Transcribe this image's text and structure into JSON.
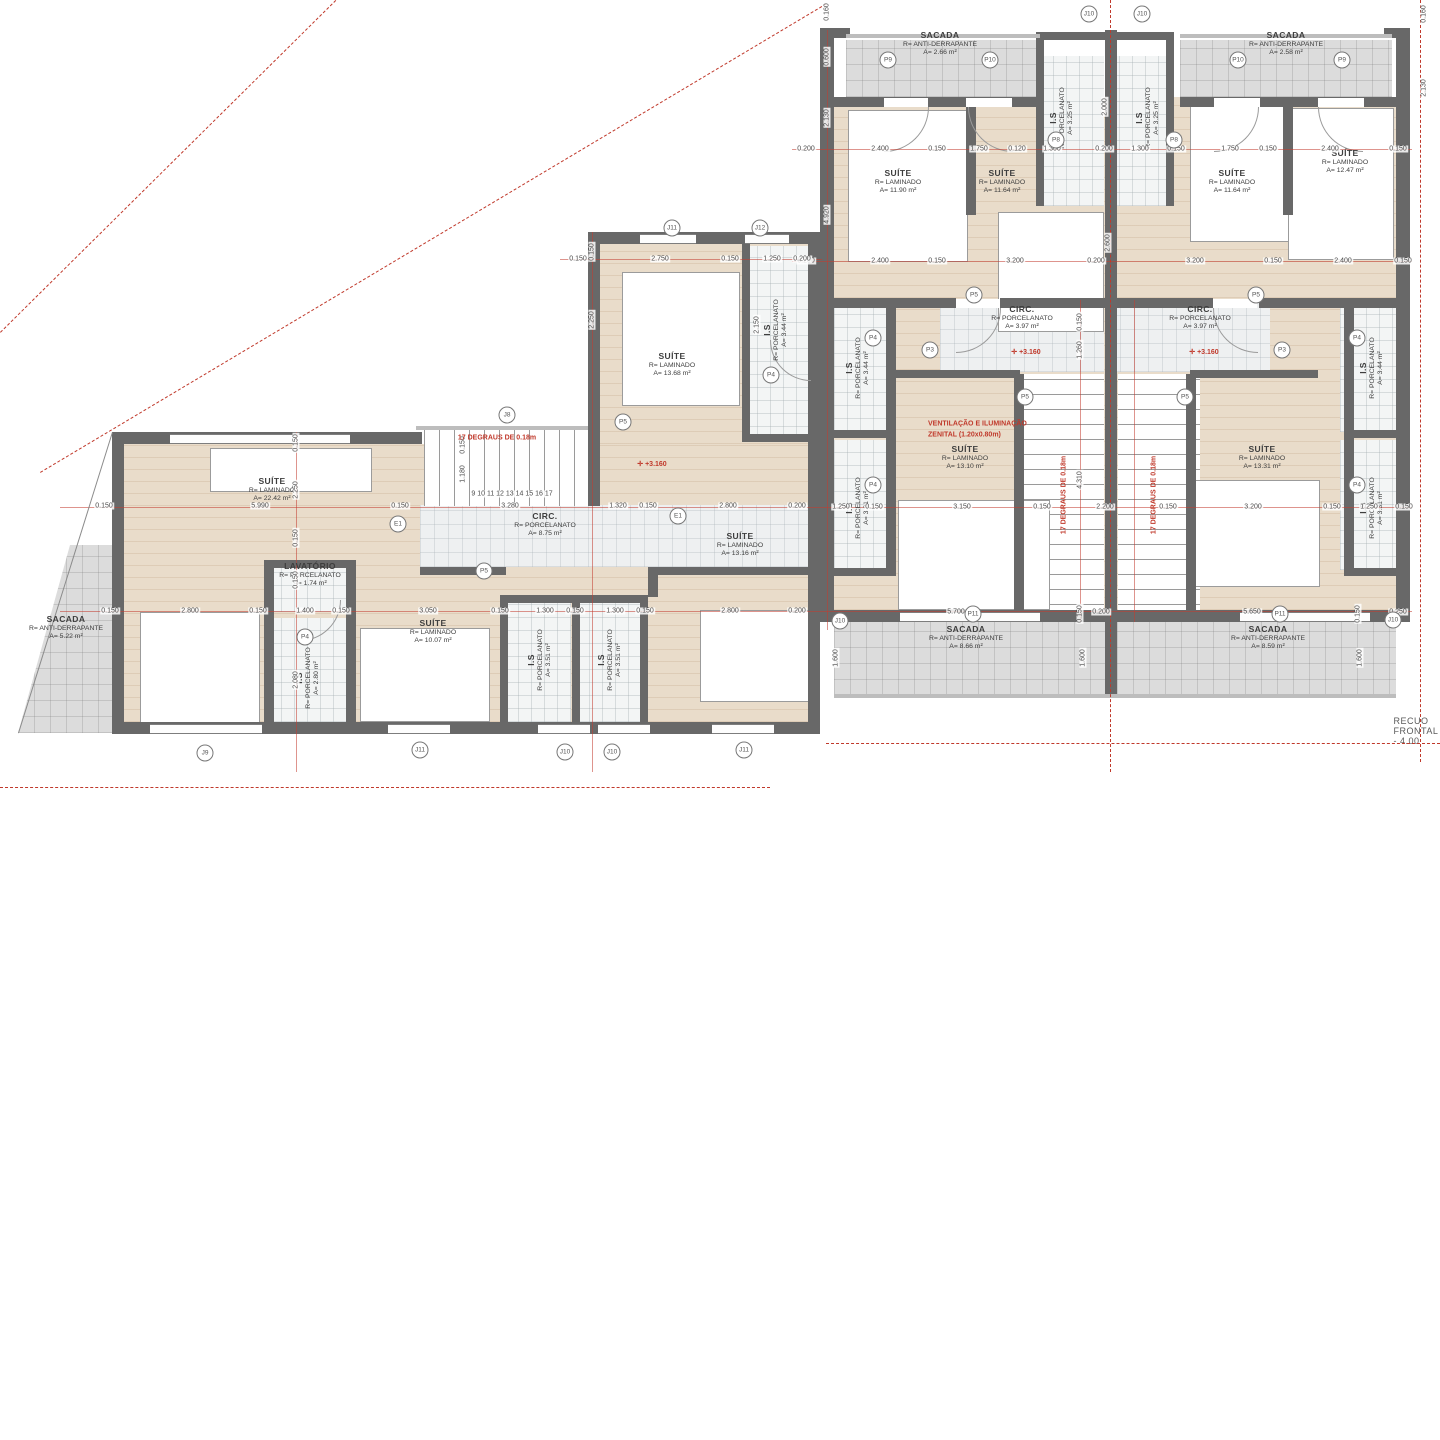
{
  "plan": {
    "recuo_label": "RECUO FRONTAL - 4.00",
    "rooms": [
      {
        "name": "sacada-esq",
        "x": 66,
        "y": 628,
        "rot": 0,
        "lines": [
          "SACADA",
          "R= ANTI-DERRAPANTE",
          "A= 5.22 m²"
        ]
      },
      {
        "name": "suite-2242",
        "x": 272,
        "y": 490,
        "rot": 0,
        "lines": [
          "SUÍTE",
          "R= LAMINADO",
          "A= 22.42 m²"
        ]
      },
      {
        "name": "circ-875",
        "x": 545,
        "y": 525,
        "rot": 0,
        "lines": [
          "CIRC.",
          "R= PORCELANATO",
          "A= 8.75 m²"
        ]
      },
      {
        "name": "suite-1368",
        "x": 672,
        "y": 365,
        "rot": 0,
        "lines": [
          "SUÍTE",
          "R= LAMINADO",
          "A= 13.68 m²"
        ]
      },
      {
        "name": "is-344-esq",
        "x": 776,
        "y": 330,
        "rot": 90,
        "lines": [
          "I.S",
          "R= PORCELANATO",
          "A= 3.44 m²"
        ]
      },
      {
        "name": "lavatorio",
        "x": 310,
        "y": 575,
        "rot": 0,
        "lines": [
          "LAVATÓRIO",
          "R= PORCELANATO",
          "A= 1.74 m²"
        ]
      },
      {
        "name": "suite-1007",
        "x": 433,
        "y": 632,
        "rot": 0,
        "lines": [
          "SUÍTE",
          "R= LAMINADO",
          "A= 10.07 m²"
        ]
      },
      {
        "name": "is-280",
        "x": 308,
        "y": 678,
        "rot": 90,
        "lines": [
          "I.S",
          "R= PORCELANATO",
          "A= 2.80 m²"
        ]
      },
      {
        "name": "is-351a",
        "x": 540,
        "y": 660,
        "rot": 90,
        "lines": [
          "I.S",
          "R= PORCELANATO",
          "A= 3.51 m²"
        ]
      },
      {
        "name": "is-351b",
        "x": 610,
        "y": 660,
        "rot": 90,
        "lines": [
          "I.S",
          "R= PORCELANATO",
          "A= 3.51 m²"
        ]
      },
      {
        "name": "suite-1316",
        "x": 740,
        "y": 545,
        "rot": 0,
        "lines": [
          "SUÍTE",
          "R= LAMINADO",
          "A= 13.16 m²"
        ]
      },
      {
        "name": "sacada-topo-a",
        "x": 940,
        "y": 44,
        "rot": 0,
        "lines": [
          "SACADA",
          "R= ANTI-DERRAPANTE",
          "A= 2.66 m²"
        ]
      },
      {
        "name": "sacada-topo-b",
        "x": 1286,
        "y": 44,
        "rot": 0,
        "lines": [
          "SACADA",
          "R= ANTI-DERRAPANTE",
          "A= 2.58 m²"
        ]
      },
      {
        "name": "is-325a",
        "x": 1062,
        "y": 118,
        "rot": 90,
        "lines": [
          "I.S",
          "R= PORCELANATO",
          "A= 3.25 m²"
        ]
      },
      {
        "name": "is-325b",
        "x": 1148,
        "y": 118,
        "rot": 90,
        "lines": [
          "I.S",
          "R= PORCELANATO",
          "A= 3.25 m²"
        ]
      },
      {
        "name": "suite-1190",
        "x": 898,
        "y": 182,
        "rot": 0,
        "lines": [
          "SUÍTE",
          "R= LAMINADO",
          "A= 11.90 m²"
        ]
      },
      {
        "name": "suite-1164a",
        "x": 1002,
        "y": 182,
        "rot": 0,
        "lines": [
          "SUÍTE",
          "R= LAMINADO",
          "A= 11.64 m²"
        ]
      },
      {
        "name": "suite-1164b",
        "x": 1232,
        "y": 182,
        "rot": 0,
        "lines": [
          "SUÍTE",
          "R= LAMINADO",
          "A= 11.64 m²"
        ]
      },
      {
        "name": "suite-1247",
        "x": 1345,
        "y": 162,
        "rot": 0,
        "lines": [
          "SUÍTE",
          "R= LAMINADO",
          "A= 12.47 m²"
        ]
      },
      {
        "name": "circ-397a",
        "x": 1022,
        "y": 318,
        "rot": 0,
        "lines": [
          "CIRC.",
          "R= PORCELANATO",
          "A= 3.97 m²"
        ]
      },
      {
        "name": "circ-397b",
        "x": 1200,
        "y": 318,
        "rot": 0,
        "lines": [
          "CIRC.",
          "R= PORCELANATO",
          "A= 3.97 m²"
        ]
      },
      {
        "name": "is-344a",
        "x": 858,
        "y": 368,
        "rot": 90,
        "lines": [
          "I.S",
          "R= PORCELANATO",
          "A= 3.44 m²"
        ]
      },
      {
        "name": "is-331a",
        "x": 858,
        "y": 508,
        "rot": 90,
        "lines": [
          "I.S",
          "R= PORCELANATO",
          "A= 3.31 m²"
        ]
      },
      {
        "name": "suite-1310",
        "x": 965,
        "y": 458,
        "rot": 0,
        "lines": [
          "SUÍTE",
          "R= LAMINADO",
          "A= 13.10 m²"
        ]
      },
      {
        "name": "suite-1331",
        "x": 1262,
        "y": 458,
        "rot": 0,
        "lines": [
          "SUÍTE",
          "R= LAMINADO",
          "A= 13.31 m²"
        ]
      },
      {
        "name": "is-344b",
        "x": 1372,
        "y": 368,
        "rot": 90,
        "lines": [
          "I.S",
          "R= PORCELANATO",
          "A= 3.44 m²"
        ]
      },
      {
        "name": "is-331b",
        "x": 1372,
        "y": 508,
        "rot": 90,
        "lines": [
          "I.S",
          "R= PORCELANATO",
          "A= 3.31 m²"
        ]
      },
      {
        "name": "sacada-baixo-a",
        "x": 966,
        "y": 638,
        "rot": 0,
        "lines": [
          "SACADA",
          "R= ANTI-DERRAPANTE",
          "A= 8.66 m²"
        ]
      },
      {
        "name": "sacada-baixo-b",
        "x": 1268,
        "y": 638,
        "rot": 0,
        "lines": [
          "SACADA",
          "R= ANTI-DERRAPANTE",
          "A= 8.59 m²"
        ]
      }
    ],
    "red_notes": [
      {
        "t": "17 DEGRAUS DE 0.18m",
        "x": 497,
        "y": 438,
        "r": 0
      },
      {
        "t": "17 DEGRAUS DE 0.18m",
        "x": 1064,
        "y": 495,
        "r": 90
      },
      {
        "t": "17 DEGRAUS DE 0.18m",
        "x": 1154,
        "y": 495,
        "r": 90
      },
      {
        "t": "VENTILAÇÃO E ILUMINAÇÃO",
        "x": 928,
        "y": 424,
        "r": 0,
        "a": "l"
      },
      {
        "t": "ZENITAL (1.20x0.80m)",
        "x": 928,
        "y": 435,
        "r": 0,
        "a": "l"
      },
      {
        "t": "+3.160",
        "x": 1026,
        "y": 352,
        "m": true
      },
      {
        "t": "+3.160",
        "x": 1204,
        "y": 352,
        "m": true
      },
      {
        "t": "+3.160",
        "x": 652,
        "y": 464,
        "m": true
      }
    ],
    "dims": [
      {
        "t": "0.200",
        "x": 806,
        "y": 149
      },
      {
        "t": "2.400",
        "x": 880,
        "y": 149
      },
      {
        "t": "0.150",
        "x": 937,
        "y": 149
      },
      {
        "t": "1.750",
        "x": 979,
        "y": 149
      },
      {
        "t": "0.120",
        "x": 1017,
        "y": 149
      },
      {
        "t": "1.300",
        "x": 1052,
        "y": 149
      },
      {
        "t": "0.200",
        "x": 1104,
        "y": 149
      },
      {
        "t": "1.300",
        "x": 1140,
        "y": 149
      },
      {
        "t": "0.150",
        "x": 1176,
        "y": 149
      },
      {
        "t": "1.750",
        "x": 1230,
        "y": 149
      },
      {
        "t": "0.150",
        "x": 1268,
        "y": 149
      },
      {
        "t": "2.400",
        "x": 1330,
        "y": 149
      },
      {
        "t": "0.150",
        "x": 1398,
        "y": 149
      },
      {
        "t": "0.200",
        "x": 806,
        "y": 261
      },
      {
        "t": "2.400",
        "x": 880,
        "y": 261
      },
      {
        "t": "0.150",
        "x": 937,
        "y": 261
      },
      {
        "t": "3.200",
        "x": 1015,
        "y": 261
      },
      {
        "t": "0.200",
        "x": 1096,
        "y": 261
      },
      {
        "t": "3.200",
        "x": 1195,
        "y": 261
      },
      {
        "t": "0.150",
        "x": 1273,
        "y": 261
      },
      {
        "t": "2.400",
        "x": 1343,
        "y": 261
      },
      {
        "t": "0.150",
        "x": 1403,
        "y": 261
      },
      {
        "t": "1.250",
        "x": 841,
        "y": 507
      },
      {
        "t": "0.150",
        "x": 874,
        "y": 507
      },
      {
        "t": "3.150",
        "x": 962,
        "y": 507
      },
      {
        "t": "0.150",
        "x": 1042,
        "y": 507
      },
      {
        "t": "2.200",
        "x": 1105,
        "y": 507
      },
      {
        "t": "0.150",
        "x": 1168,
        "y": 507
      },
      {
        "t": "3.200",
        "x": 1253,
        "y": 507
      },
      {
        "t": "0.150",
        "x": 1332,
        "y": 507
      },
      {
        "t": "1.250",
        "x": 1369,
        "y": 507
      },
      {
        "t": "0.150",
        "x": 1404,
        "y": 507
      },
      {
        "t": "5.700",
        "x": 956,
        "y": 612
      },
      {
        "t": "0.200",
        "x": 1101,
        "y": 612
      },
      {
        "t": "5.650",
        "x": 1252,
        "y": 612
      },
      {
        "t": "0.250",
        "x": 1398,
        "y": 612
      },
      {
        "t": "1.600",
        "x": 836,
        "y": 658,
        "r": 90
      },
      {
        "t": "0.150",
        "x": 1080,
        "y": 614,
        "r": 90
      },
      {
        "t": "1.600",
        "x": 1083,
        "y": 658,
        "r": 90
      },
      {
        "t": "0.150",
        "x": 1358,
        "y": 614,
        "r": 90
      },
      {
        "t": "1.600",
        "x": 1360,
        "y": 658,
        "r": 90
      },
      {
        "t": "0.150",
        "x": 104,
        "y": 506
      },
      {
        "t": "5.990",
        "x": 260,
        "y": 506
      },
      {
        "t": "0.150",
        "x": 400,
        "y": 506
      },
      {
        "t": "3.280",
        "x": 510,
        "y": 506
      },
      {
        "t": "1.320",
        "x": 618,
        "y": 506
      },
      {
        "t": "0.150",
        "x": 648,
        "y": 506
      },
      {
        "t": "2.800",
        "x": 728,
        "y": 506
      },
      {
        "t": "0.200",
        "x": 797,
        "y": 506
      },
      {
        "t": "0.150",
        "x": 578,
        "y": 259
      },
      {
        "t": "2.750",
        "x": 660,
        "y": 259
      },
      {
        "t": "0.150",
        "x": 730,
        "y": 259
      },
      {
        "t": "1.250",
        "x": 772,
        "y": 259
      },
      {
        "t": "0.200",
        "x": 802,
        "y": 259
      },
      {
        "t": "0.150",
        "x": 110,
        "y": 611
      },
      {
        "t": "2.800",
        "x": 190,
        "y": 611
      },
      {
        "t": "0.150",
        "x": 258,
        "y": 611
      },
      {
        "t": "1.400",
        "x": 305,
        "y": 611
      },
      {
        "t": "0.150",
        "x": 341,
        "y": 611
      },
      {
        "t": "3.050",
        "x": 428,
        "y": 611
      },
      {
        "t": "0.150",
        "x": 500,
        "y": 611
      },
      {
        "t": "1.300",
        "x": 545,
        "y": 611
      },
      {
        "t": "0.150",
        "x": 575,
        "y": 611
      },
      {
        "t": "1.300",
        "x": 615,
        "y": 611
      },
      {
        "t": "0.150",
        "x": 645,
        "y": 611
      },
      {
        "t": "2.800",
        "x": 730,
        "y": 611
      },
      {
        "t": "0.200",
        "x": 797,
        "y": 611
      },
      {
        "t": "0.150",
        "x": 296,
        "y": 443,
        "r": 90
      },
      {
        "t": "2.250",
        "x": 296,
        "y": 490,
        "r": 90
      },
      {
        "t": "0.150",
        "x": 296,
        "y": 538,
        "r": 90
      },
      {
        "t": "0.150",
        "x": 296,
        "y": 580,
        "r": 90
      },
      {
        "t": "2.080",
        "x": 296,
        "y": 680,
        "r": 90
      },
      {
        "t": "0.150",
        "x": 592,
        "y": 252,
        "r": 90
      },
      {
        "t": "2.250",
        "x": 592,
        "y": 320,
        "r": 90
      },
      {
        "t": "0.150",
        "x": 463,
        "y": 445,
        "r": 90
      },
      {
        "t": "1.180",
        "x": 463,
        "y": 474,
        "r": 90
      },
      {
        "t": "2.150",
        "x": 757,
        "y": 325,
        "r": 90
      },
      {
        "t": "0.160",
        "x": 827,
        "y": 12,
        "r": 90
      },
      {
        "t": "0.600",
        "x": 827,
        "y": 57,
        "r": 90
      },
      {
        "t": "2.130",
        "x": 827,
        "y": 118,
        "r": 90
      },
      {
        "t": "4.920",
        "x": 827,
        "y": 215,
        "r": 90
      },
      {
        "t": "2.000",
        "x": 1105,
        "y": 107,
        "r": 90
      },
      {
        "t": "2.600",
        "x": 1108,
        "y": 243,
        "r": 90
      },
      {
        "t": "0.150",
        "x": 1080,
        "y": 322,
        "r": 90
      },
      {
        "t": "1.260",
        "x": 1080,
        "y": 350,
        "r": 90
      },
      {
        "t": "4.310",
        "x": 1080,
        "y": 480,
        "r": 90
      },
      {
        "t": "0.160",
        "x": 1424,
        "y": 14,
        "r": 90
      },
      {
        "t": "2.130",
        "x": 1424,
        "y": 88,
        "r": 90
      },
      {
        "t": "9   10   11   12   13   14   15   16   17",
        "x": 512,
        "y": 494
      }
    ],
    "badges": [
      {
        "t": "P9",
        "x": 888,
        "y": 60
      },
      {
        "t": "P10",
        "x": 990,
        "y": 60
      },
      {
        "t": "P10",
        "x": 1238,
        "y": 60
      },
      {
        "t": "P9",
        "x": 1342,
        "y": 60
      },
      {
        "t": "J10",
        "x": 1089,
        "y": 14
      },
      {
        "t": "J10",
        "x": 1142,
        "y": 14
      },
      {
        "t": "P8",
        "x": 1056,
        "y": 140
      },
      {
        "t": "P8",
        "x": 1174,
        "y": 140
      },
      {
        "t": "P5",
        "x": 974,
        "y": 295
      },
      {
        "t": "P5",
        "x": 1256,
        "y": 295
      },
      {
        "t": "P4",
        "x": 873,
        "y": 338
      },
      {
        "t": "P3",
        "x": 930,
        "y": 350
      },
      {
        "t": "P3",
        "x": 1282,
        "y": 350
      },
      {
        "t": "P4",
        "x": 1357,
        "y": 338
      },
      {
        "t": "P5",
        "x": 1025,
        "y": 397
      },
      {
        "t": "P5",
        "x": 1185,
        "y": 397
      },
      {
        "t": "P4",
        "x": 873,
        "y": 485
      },
      {
        "t": "P4",
        "x": 1357,
        "y": 485
      },
      {
        "t": "J10",
        "x": 840,
        "y": 621
      },
      {
        "t": "P11",
        "x": 973,
        "y": 614
      },
      {
        "t": "P11",
        "x": 1280,
        "y": 614
      },
      {
        "t": "J10",
        "x": 1393,
        "y": 620
      },
      {
        "t": "J11",
        "x": 672,
        "y": 228
      },
      {
        "t": "J12",
        "x": 760,
        "y": 228
      },
      {
        "t": "J8",
        "x": 507,
        "y": 415
      },
      {
        "t": "E1",
        "x": 398,
        "y": 524
      },
      {
        "t": "E1",
        "x": 678,
        "y": 516
      },
      {
        "t": "P5",
        "x": 484,
        "y": 571
      },
      {
        "t": "P5",
        "x": 623,
        "y": 422
      },
      {
        "t": "P4",
        "x": 771,
        "y": 375
      },
      {
        "t": "P4",
        "x": 305,
        "y": 637
      },
      {
        "t": "J9",
        "x": 205,
        "y": 753
      },
      {
        "t": "J11",
        "x": 420,
        "y": 750
      },
      {
        "t": "J10",
        "x": 565,
        "y": 752
      },
      {
        "t": "J10",
        "x": 612,
        "y": 752
      },
      {
        "t": "J11",
        "x": 744,
        "y": 750
      }
    ]
  }
}
